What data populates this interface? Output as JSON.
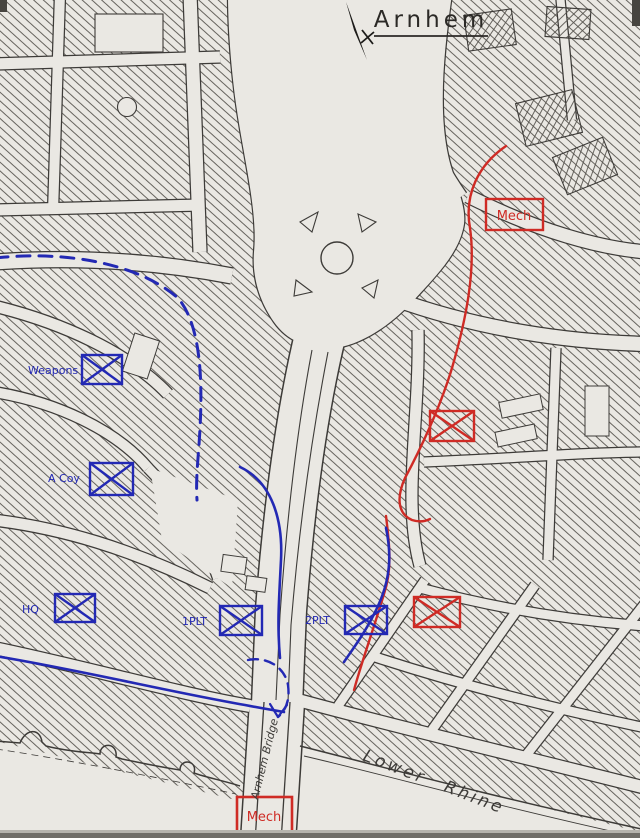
{
  "title": "Arnhem",
  "labels": {
    "bridge": "Arnhem Bridge",
    "river": "Lower Rhine"
  },
  "icons": {
    "compass": "north-arrow"
  },
  "units": {
    "friendly": [
      {
        "id": "weapons",
        "label": "Weapons",
        "symbol": "infantry-box-x"
      },
      {
        "id": "a-coy",
        "label": "A Coy",
        "symbol": "infantry-box-x"
      },
      {
        "id": "hq",
        "label": "HQ",
        "symbol": "infantry-box-x"
      },
      {
        "id": "1plt",
        "label": "1PLT",
        "symbol": "infantry-box-x"
      },
      {
        "id": "2plt",
        "label": "2PLT",
        "symbol": "infantry-box-x"
      }
    ],
    "enemy": [
      {
        "id": "mech-north",
        "label": "Mech",
        "symbol": "boxed-label"
      },
      {
        "id": "enemy-mid",
        "label": "",
        "symbol": "infantry-box-x"
      },
      {
        "id": "enemy-south",
        "label": "",
        "symbol": "infantry-box-x"
      },
      {
        "id": "mech-bridge",
        "label": "Mech",
        "symbol": "boxed-label"
      }
    ]
  },
  "colors": {
    "friendly_ink": "#2329b4",
    "enemy_ink": "#cf2b25",
    "pen": "#3d3b38",
    "paper": "#eae8e3"
  }
}
